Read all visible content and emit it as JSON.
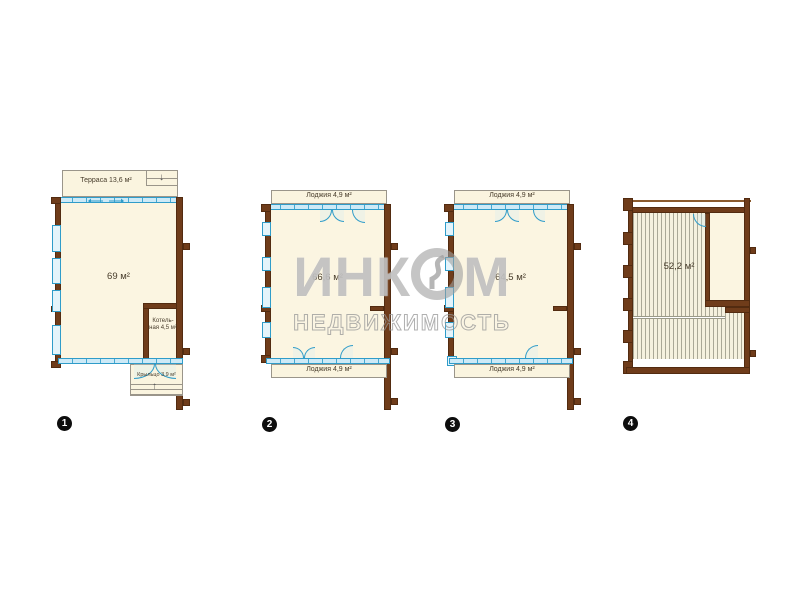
{
  "watermark": {
    "brand_left": "ИНК",
    "brand_right": "М",
    "subtitle": "НЕДВИЖИМОСТЬ"
  },
  "icons": {
    "stairs_down": "↓",
    "stairs_up": "↑"
  },
  "colors": {
    "wall_brown": "#6f3c1a",
    "glass_blue": "#cdeaf7",
    "glass_border": "#2f9cc9",
    "room_cream": "#fbf5e1",
    "watermark_gray": "#9e9e9e",
    "badge_black": "#0d0d0d"
  },
  "plans": [
    {
      "number": "1",
      "labels": {
        "terrace": "Терраса 13,6 м²",
        "area": "69 м²",
        "boiler_line1": "Котель-",
        "boiler_line2": "ная 4,5 м²",
        "porch": "Крыльцо 3,9 м²"
      }
    },
    {
      "number": "2",
      "labels": {
        "loggia_top": "Лоджия 4,9 м²",
        "area": "66,6 м²",
        "loggia_bottom": "Лоджия 4,9 м²"
      }
    },
    {
      "number": "3",
      "labels": {
        "loggia_top": "Лоджия 4,9 м²",
        "area": "64,5 м²",
        "loggia_bottom": "Лоджия 4,9 м²"
      }
    },
    {
      "number": "4",
      "labels": {
        "area": "52,2 м²"
      }
    }
  ]
}
